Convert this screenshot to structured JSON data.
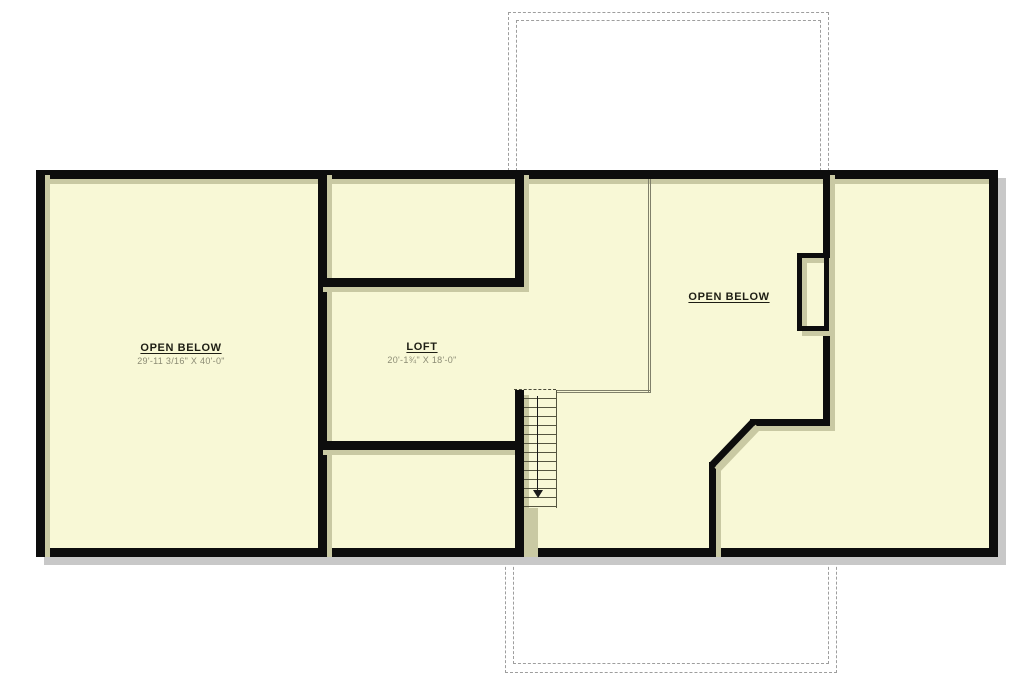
{
  "colors": {
    "floor": "#f8f8d6",
    "wall": "#0d0d0d",
    "wallshadow": "#c9c9a3",
    "dropshadow": "#c8c8c8",
    "outline": "#9e9e9e",
    "roomname": "#1e1e14",
    "dimtext": "#8b8b74",
    "treadline": "#55553f",
    "openingline": "#80806a"
  },
  "rooms": {
    "open_below_left": {
      "name": "OPEN BELOW",
      "dimensions": "29'-11 3/16\" X 40'-0\""
    },
    "loft": {
      "name": "LOFT",
      "dimensions": "20'-1¾\" X 18'-0\""
    },
    "open_below_right": {
      "name": "OPEN BELOW"
    }
  },
  "stairs": {
    "direction": "down"
  },
  "icons": {
    "stair_direction_arrow": "down-arrow"
  }
}
